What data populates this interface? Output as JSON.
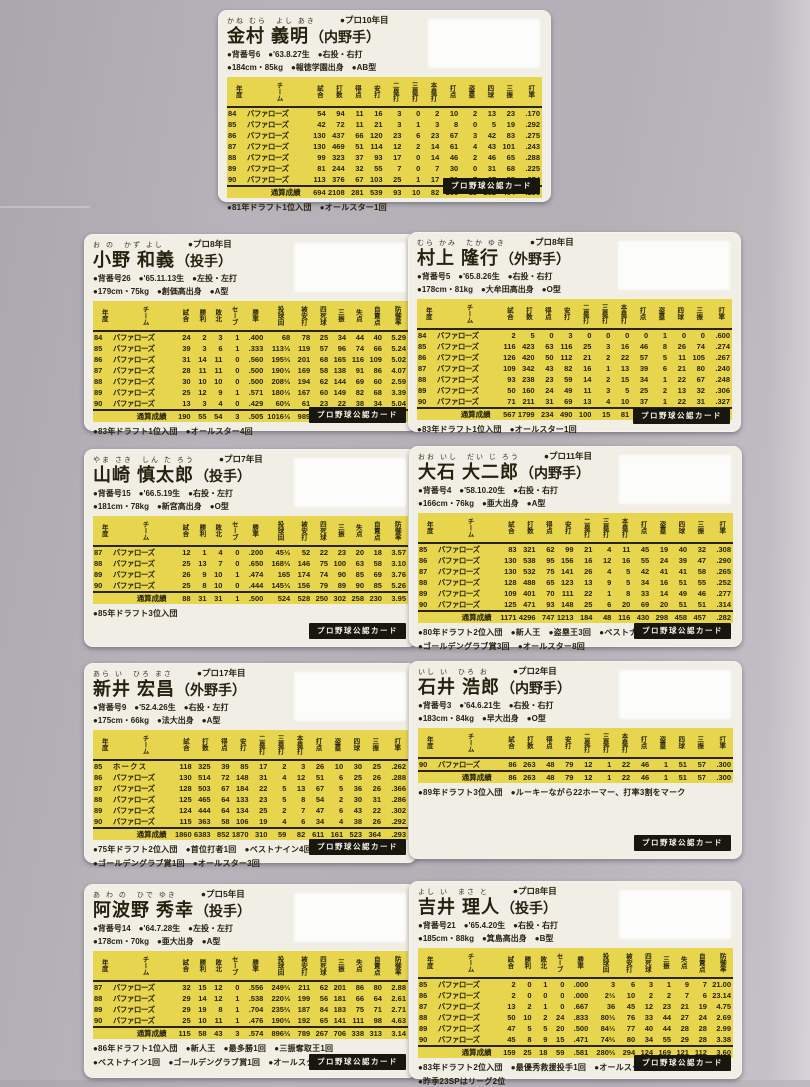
{
  "badge_label": "プロ野球公認カード",
  "batter_headers": [
    "年度",
    "チーム",
    "試合",
    "打数",
    "得点",
    "安打",
    "二塁打",
    "三塁打",
    "本塁打",
    "打点",
    "盗塁",
    "四球",
    "三振",
    "打率"
  ],
  "pitcher_headers": [
    "年度",
    "チーム",
    "試合",
    "勝利",
    "敗北",
    "セーブ",
    "勝率",
    "投球回",
    "被安打",
    "四死球",
    "三振",
    "失点",
    "自責点",
    "防御率"
  ],
  "cards": [
    {
      "type": "batter",
      "furigana": "かね むら　よし あき",
      "pro_year": "●プロ10年目",
      "name": "金村 義明",
      "position": "（内野手）",
      "info1": "●背番号6　●'63.8.27生　●右投・右打",
      "info2": "●184cm・85kg　●報徳学園出身　●AB型",
      "rows": [
        [
          "84",
          "バファローズ",
          "54",
          "94",
          "11",
          "16",
          "3",
          "0",
          "2",
          "10",
          "2",
          "13",
          "23",
          ".170"
        ],
        [
          "85",
          "バファローズ",
          "42",
          "72",
          "11",
          "21",
          "3",
          "1",
          "3",
          "8",
          "0",
          "5",
          "19",
          ".292"
        ],
        [
          "86",
          "バファローズ",
          "130",
          "437",
          "66",
          "120",
          "23",
          "6",
          "23",
          "67",
          "3",
          "42",
          "83",
          ".275"
        ],
        [
          "87",
          "バファローズ",
          "130",
          "469",
          "51",
          "114",
          "12",
          "2",
          "14",
          "61",
          "4",
          "43",
          "101",
          ".243"
        ],
        [
          "88",
          "バファローズ",
          "99",
          "323",
          "37",
          "93",
          "17",
          "0",
          "14",
          "46",
          "2",
          "46",
          "65",
          ".288"
        ],
        [
          "89",
          "バファローズ",
          "81",
          "244",
          "32",
          "55",
          "7",
          "0",
          "7",
          "30",
          "0",
          "31",
          "68",
          ".225"
        ],
        [
          "90",
          "バファローズ",
          "113",
          "376",
          "67",
          "103",
          "25",
          "1",
          "17",
          "51",
          "7",
          "67",
          "85",
          ".274"
        ]
      ],
      "total": [
        "通算成績",
        "694",
        "2108",
        "281",
        "539",
        "93",
        "10",
        "82",
        "266",
        "19",
        "252",
        "464",
        ".256"
      ],
      "notes": [
        "●81年ドラフト1位入団　●オールスター1回"
      ]
    },
    {
      "type": "pitcher",
      "furigana": "お の　かず よし",
      "pro_year": "●プロ8年目",
      "name": "小野 和義",
      "position": "（投手）",
      "info1": "●背番号26　●'65.11.13生　●左投・左打",
      "info2": "●179cm・75kg　●創価高出身　●A型",
      "rows": [
        [
          "84",
          "バファローズ",
          "24",
          "2",
          "3",
          "1",
          ".400",
          "68",
          "78",
          "25",
          "34",
          "44",
          "40",
          "5.29"
        ],
        [
          "85",
          "バファローズ",
          "39",
          "3",
          "6",
          "1",
          ".333",
          "113⅓",
          "119",
          "57",
          "96",
          "74",
          "66",
          "5.24"
        ],
        [
          "86",
          "バファローズ",
          "31",
          "14",
          "11",
          "0",
          ".560",
          "195⅔",
          "201",
          "68",
          "165",
          "116",
          "109",
          "5.02"
        ],
        [
          "87",
          "バファローズ",
          "28",
          "11",
          "11",
          "0",
          ".500",
          "190⅓",
          "169",
          "58",
          "138",
          "91",
          "86",
          "4.07"
        ],
        [
          "88",
          "バファローズ",
          "30",
          "10",
          "10",
          "0",
          ".500",
          "208⅔",
          "194",
          "62",
          "144",
          "69",
          "60",
          "2.59"
        ],
        [
          "89",
          "バファローズ",
          "25",
          "12",
          "9",
          "1",
          ".571",
          "180⅓",
          "167",
          "60",
          "149",
          "82",
          "68",
          "3.39"
        ],
        [
          "90",
          "バファローズ",
          "13",
          "3",
          "4",
          "0",
          ".429",
          "60⅔",
          "61",
          "23",
          "22",
          "38",
          "34",
          "5.04"
        ]
      ],
      "total": [
        "通算成績",
        "190",
        "55",
        "54",
        "3",
        ".505",
        "1016⅓",
        "989",
        "353",
        "748",
        "514",
        "463",
        "4.10"
      ],
      "notes": [
        "●83年ドラフト1位入団　●オールスター4回"
      ]
    },
    {
      "type": "batter",
      "furigana": "むら かみ　たか ゆき",
      "pro_year": "●プロ8年目",
      "name": "村上 隆行",
      "position": "（外野手）",
      "info1": "●背番号5　●'65.8.26生　●右投・右打",
      "info2": "●178cm・81kg　●大牟田高出身　●O型",
      "rows": [
        [
          "84",
          "バファローズ",
          "2",
          "5",
          "0",
          "3",
          "0",
          "0",
          "0",
          "0",
          "1",
          "0",
          "0",
          ".600"
        ],
        [
          "85",
          "バファローズ",
          "116",
          "423",
          "63",
          "116",
          "25",
          "3",
          "16",
          "46",
          "8",
          "26",
          "74",
          ".274"
        ],
        [
          "86",
          "バファローズ",
          "126",
          "420",
          "50",
          "112",
          "21",
          "2",
          "22",
          "57",
          "5",
          "11",
          "105",
          ".267"
        ],
        [
          "87",
          "バファローズ",
          "109",
          "342",
          "43",
          "82",
          "16",
          "1",
          "13",
          "39",
          "6",
          "21",
          "80",
          ".240"
        ],
        [
          "88",
          "バファローズ",
          "93",
          "238",
          "23",
          "59",
          "14",
          "2",
          "15",
          "34",
          "1",
          "22",
          "67",
          ".248"
        ],
        [
          "89",
          "バファローズ",
          "50",
          "160",
          "24",
          "49",
          "11",
          "3",
          "5",
          "25",
          "2",
          "13",
          "32",
          ".306"
        ],
        [
          "90",
          "バファローズ",
          "71",
          "211",
          "31",
          "69",
          "13",
          "4",
          "10",
          "37",
          "1",
          "22",
          "31",
          ".327"
        ]
      ],
      "total": [
        "通算成績",
        "567",
        "1799",
        "234",
        "490",
        "100",
        "15",
        "81",
        "238",
        "24",
        "115",
        "389",
        ".272"
      ],
      "notes": [
        "●83年ドラフト1位入団　●オールスター1回"
      ]
    },
    {
      "type": "pitcher",
      "furigana": "やま さき　しん た ろう",
      "pro_year": "●プロ7年目",
      "name": "山崎 慎太郎",
      "position": "（投手）",
      "info1": "●背番号15　●'66.5.19生　●右投・左打",
      "info2": "●181cm・78kg　●新宮高出身　●O型",
      "rows": [
        [
          "87",
          "バファローズ",
          "12",
          "1",
          "4",
          "0",
          ".200",
          "45⅓",
          "52",
          "22",
          "23",
          "20",
          "18",
          "3.57"
        ],
        [
          "88",
          "バファローズ",
          "25",
          "13",
          "7",
          "0",
          ".650",
          "168⅔",
          "146",
          "75",
          "100",
          "63",
          "58",
          "3.10"
        ],
        [
          "89",
          "バファローズ",
          "26",
          "9",
          "10",
          "1",
          ".474",
          "165",
          "174",
          "74",
          "90",
          "85",
          "69",
          "3.76"
        ],
        [
          "90",
          "バファローズ",
          "25",
          "8",
          "10",
          "0",
          ".444",
          "145⅓",
          "156",
          "79",
          "89",
          "90",
          "85",
          "5.26"
        ]
      ],
      "total": [
        "通算成績",
        "88",
        "31",
        "31",
        "1",
        ".500",
        "524",
        "528",
        "250",
        "302",
        "258",
        "230",
        "3.95"
      ],
      "notes": [
        "●85年ドラフト3位入団"
      ]
    },
    {
      "type": "batter",
      "furigana": "おお いし　だい じ ろう",
      "pro_year": "●プロ11年目",
      "name": "大石 大二郎",
      "position": "（内野手）",
      "info1": "●背番号4　●'58.10.20生　●右投・右打",
      "info2": "●166cm・76kg　●亜大出身　●A型",
      "rows": [
        [
          "85",
          "バファローズ",
          "83",
          "321",
          "62",
          "99",
          "21",
          "4",
          "11",
          "45",
          "19",
          "40",
          "32",
          ".308"
        ],
        [
          "86",
          "バファローズ",
          "130",
          "538",
          "95",
          "156",
          "16",
          "12",
          "16",
          "55",
          "24",
          "39",
          "47",
          ".290"
        ],
        [
          "87",
          "バファローズ",
          "130",
          "532",
          "75",
          "141",
          "26",
          "4",
          "5",
          "42",
          "41",
          "41",
          "58",
          ".265"
        ],
        [
          "88",
          "バファローズ",
          "128",
          "488",
          "65",
          "123",
          "13",
          "9",
          "5",
          "34",
          "16",
          "51",
          "55",
          ".252"
        ],
        [
          "89",
          "バファローズ",
          "109",
          "401",
          "70",
          "111",
          "22",
          "1",
          "8",
          "33",
          "14",
          "49",
          "46",
          ".277"
        ],
        [
          "90",
          "バファローズ",
          "125",
          "471",
          "93",
          "148",
          "25",
          "6",
          "20",
          "69",
          "20",
          "51",
          "51",
          ".314"
        ]
      ],
      "total": [
        "通算成績",
        "1171",
        "4296",
        "747",
        "1213",
        "184",
        "48",
        "116",
        "430",
        "298",
        "458",
        "457",
        ".282"
      ],
      "notes": [
        "●80年ドラフト2位入団　●新人王　●盗塁王3回　●ベストナイン3回",
        "●ゴールデングラブ賞3回　●オールスター8回"
      ]
    },
    {
      "type": "batter",
      "furigana": "あら い　ひろ まさ",
      "pro_year": "●プロ17年目",
      "name": "新井 宏昌",
      "position": "（外野手）",
      "info1": "●背番号9　●'52.4.26生　●右投・左打",
      "info2": "●175cm・66kg　●法大出身　●A型",
      "rows": [
        [
          "85",
          "ホ ー ク ス",
          "118",
          "325",
          "39",
          "85",
          "17",
          "2",
          "3",
          "26",
          "10",
          "30",
          "25",
          ".262"
        ],
        [
          "86",
          "バファローズ",
          "130",
          "514",
          "72",
          "148",
          "31",
          "4",
          "12",
          "51",
          "6",
          "25",
          "26",
          ".288"
        ],
        [
          "87",
          "バファローズ",
          "128",
          "503",
          "67",
          "184",
          "22",
          "5",
          "13",
          "67",
          "5",
          "36",
          "26",
          ".366"
        ],
        [
          "88",
          "バファローズ",
          "125",
          "465",
          "64",
          "133",
          "23",
          "5",
          "8",
          "54",
          "2",
          "30",
          "31",
          ".286"
        ],
        [
          "89",
          "バファローズ",
          "124",
          "444",
          "64",
          "134",
          "25",
          "2",
          "7",
          "47",
          "6",
          "43",
          "22",
          ".302"
        ],
        [
          "90",
          "バファローズ",
          "115",
          "363",
          "58",
          "106",
          "19",
          "4",
          "6",
          "34",
          "4",
          "38",
          "26",
          ".292"
        ]
      ],
      "total": [
        "通算成績",
        "1860",
        "6383",
        "852",
        "1870",
        "310",
        "59",
        "82",
        "611",
        "161",
        "523",
        "364",
        ".293"
      ],
      "notes": [
        "●75年ドラフト2位入団　●首位打者1回　●ベストナイン4回",
        "●ゴールデングラブ賞1回　●オールスター3回"
      ]
    },
    {
      "type": "batter",
      "furigana": "いし い　ひろ お",
      "pro_year": "●プロ2年目",
      "name": "石井 浩郎",
      "position": "（内野手）",
      "info1": "●背番号3　●'64.6.21生　●右投・右打",
      "info2": "●183cm・84kg　●早大出身　●O型",
      "rows": [
        [
          "90",
          "バファローズ",
          "86",
          "263",
          "48",
          "79",
          "12",
          "1",
          "22",
          "46",
          "1",
          "51",
          "57",
          ".300"
        ]
      ],
      "total": [
        "通算成績",
        "86",
        "263",
        "48",
        "79",
        "12",
        "1",
        "22",
        "46",
        "1",
        "51",
        "57",
        ".300"
      ],
      "notes": [
        "●89年ドラフト3位入団　●ルーキーながら22ホーマー、打率3割をマーク"
      ]
    },
    {
      "type": "pitcher",
      "furigana": "あ わ の　ひで ゆき",
      "pro_year": "●プロ5年目",
      "name": "阿波野 秀幸",
      "position": "（投手）",
      "info1": "●背番号14　●'64.7.28生　●左投・左打",
      "info2": "●178cm・70kg　●亜大出身　●A型",
      "rows": [
        [
          "87",
          "バファローズ",
          "32",
          "15",
          "12",
          "0",
          ".556",
          "249⅔",
          "211",
          "62",
          "201",
          "86",
          "80",
          "2.88"
        ],
        [
          "88",
          "バファローズ",
          "29",
          "14",
          "12",
          "1",
          ".538",
          "220⅓",
          "199",
          "56",
          "181",
          "66",
          "64",
          "2.61"
        ],
        [
          "89",
          "バファローズ",
          "29",
          "19",
          "8",
          "1",
          ".704",
          "235⅔",
          "187",
          "84",
          "183",
          "75",
          "71",
          "2.71"
        ],
        [
          "90",
          "バファローズ",
          "25",
          "10",
          "11",
          "1",
          ".476",
          "190⅔",
          "192",
          "65",
          "141",
          "111",
          "98",
          "4.63"
        ]
      ],
      "total": [
        "通算成績",
        "115",
        "58",
        "43",
        "3",
        ".574",
        "896⅔",
        "789",
        "267",
        "706",
        "338",
        "313",
        "3.14"
      ],
      "notes": [
        "●86年ドラフト1位入団　●新人王　●最多勝1回　●三振奪取王1回",
        "●ベストナイン1回　●ゴールデングラブ賞1回　●オールスター4回"
      ]
    },
    {
      "type": "pitcher",
      "furigana": "よし い　まさ と",
      "pro_year": "●プロ8年目",
      "name": "吉井 理人",
      "position": "（投手）",
      "info1": "●背番号21　●'65.4.20生　●右投・右打",
      "info2": "●185cm・88kg　●箕島高出身　●B型",
      "rows": [
        [
          "85",
          "バファローズ",
          "2",
          "0",
          "1",
          "0",
          ".000",
          "3",
          "6",
          "3",
          "1",
          "9",
          "7",
          "21.00"
        ],
        [
          "86",
          "バファローズ",
          "2",
          "0",
          "0",
          "0",
          ".000",
          "2⅓",
          "10",
          "2",
          "2",
          "7",
          "6",
          "23.14"
        ],
        [
          "87",
          "バファローズ",
          "13",
          "2",
          "1",
          "0",
          ".667",
          "36",
          "45",
          "12",
          "23",
          "21",
          "19",
          "4.75"
        ],
        [
          "88",
          "バファローズ",
          "50",
          "10",
          "2",
          "24",
          ".833",
          "80⅓",
          "76",
          "33",
          "44",
          "27",
          "24",
          "2.69"
        ],
        [
          "89",
          "バファローズ",
          "47",
          "5",
          "5",
          "20",
          ".500",
          "84⅓",
          "77",
          "40",
          "44",
          "28",
          "28",
          "2.99"
        ],
        [
          "90",
          "バファローズ",
          "45",
          "8",
          "9",
          "15",
          ".471",
          "74⅔",
          "80",
          "34",
          "55",
          "29",
          "28",
          "3.38"
        ]
      ],
      "total": [
        "通算成績",
        "159",
        "25",
        "18",
        "59",
        ".581",
        "280⅔",
        "294",
        "124",
        "169",
        "121",
        "112",
        "3.60"
      ],
      "notes": [
        "●83年ドラフト2位入団　●最優秀救援投手1回　●オールスター1回",
        "●昨季23SPはリーグ2位"
      ]
    }
  ]
}
